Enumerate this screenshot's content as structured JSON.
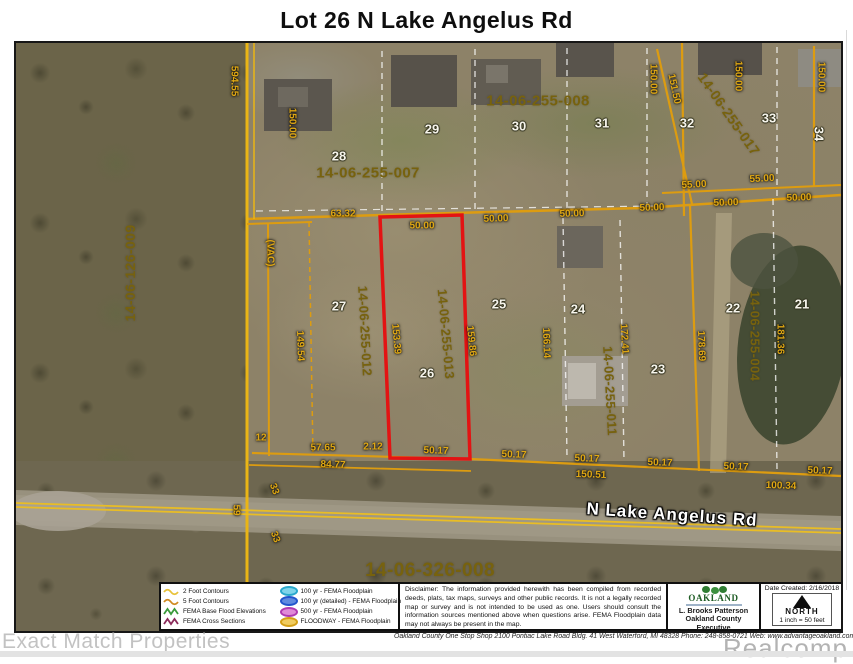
{
  "title": "Lot 26 N Lake Angelus Rd",
  "map": {
    "road_name": "N Lake Angelus Rd",
    "subject_lot": "26",
    "subject_parcel_id": "14-06-255-013",
    "labels": [
      {
        "t": "594.55",
        "x": 218,
        "y": 38,
        "r": 90,
        "k": "dim"
      },
      {
        "t": "150.00",
        "x": 276,
        "y": 80,
        "r": 90,
        "k": "dim"
      },
      {
        "t": "63.32",
        "x": 327,
        "y": 171,
        "r": 0,
        "k": "dim"
      },
      {
        "t": "50.00",
        "x": 406,
        "y": 183,
        "r": 0,
        "k": "dim"
      },
      {
        "t": "50.00",
        "x": 480,
        "y": 176,
        "r": -2,
        "k": "dim"
      },
      {
        "t": "50.00",
        "x": 556,
        "y": 171,
        "r": -2,
        "k": "dim"
      },
      {
        "t": "50.00",
        "x": 636,
        "y": 165,
        "r": -2,
        "k": "dim"
      },
      {
        "t": "50.00",
        "x": 710,
        "y": 160,
        "r": -2,
        "k": "dim"
      },
      {
        "t": "50.00",
        "x": 783,
        "y": 155,
        "r": -2,
        "k": "dim"
      },
      {
        "t": "55.00",
        "x": 678,
        "y": 142,
        "r": -3,
        "k": "dim"
      },
      {
        "t": "55.00",
        "x": 746,
        "y": 136,
        "r": -3,
        "k": "dim"
      },
      {
        "t": "150.00",
        "x": 637,
        "y": 36,
        "r": 90,
        "k": "dim"
      },
      {
        "t": "151.50",
        "x": 658,
        "y": 46,
        "r": 78,
        "k": "dim"
      },
      {
        "t": "150.00",
        "x": 722,
        "y": 33,
        "r": 90,
        "k": "dim"
      },
      {
        "t": "150.00",
        "x": 805,
        "y": 34,
        "r": 90,
        "k": "dim"
      },
      {
        "t": "(VAC)",
        "x": 254,
        "y": 210,
        "r": 90,
        "k": "dim"
      },
      {
        "t": "149.54",
        "x": 284,
        "y": 303,
        "r": 88,
        "k": "dim"
      },
      {
        "t": "153.39",
        "x": 380,
        "y": 296,
        "r": 85,
        "k": "dim"
      },
      {
        "t": "159.86",
        "x": 455,
        "y": 298,
        "r": 84,
        "k": "dim"
      },
      {
        "t": "166.14",
        "x": 530,
        "y": 300,
        "r": 88,
        "k": "dim"
      },
      {
        "t": "172.41",
        "x": 608,
        "y": 296,
        "r": 86,
        "k": "dim"
      },
      {
        "t": "178.69",
        "x": 685,
        "y": 303,
        "r": 88,
        "k": "dim"
      },
      {
        "t": "181.36",
        "x": 764,
        "y": 296,
        "r": 90,
        "k": "dim"
      },
      {
        "t": "12",
        "x": 245,
        "y": 395,
        "r": 0,
        "k": "dim"
      },
      {
        "t": "57.65",
        "x": 307,
        "y": 405,
        "r": 0,
        "k": "dim"
      },
      {
        "t": "2.12",
        "x": 357,
        "y": 404,
        "r": 0,
        "k": "dim"
      },
      {
        "t": "50.17",
        "x": 420,
        "y": 408,
        "r": 2,
        "k": "dim"
      },
      {
        "t": "50.17",
        "x": 498,
        "y": 412,
        "r": 2,
        "k": "dim"
      },
      {
        "t": "84.77",
        "x": 317,
        "y": 422,
        "r": 2,
        "k": "dim"
      },
      {
        "t": "50.17",
        "x": 571,
        "y": 416,
        "r": 2,
        "k": "dim"
      },
      {
        "t": "50.17",
        "x": 644,
        "y": 420,
        "r": 2,
        "k": "dim"
      },
      {
        "t": "50.17",
        "x": 720,
        "y": 424,
        "r": 2,
        "k": "dim"
      },
      {
        "t": "50.17",
        "x": 804,
        "y": 428,
        "r": 2,
        "k": "dim"
      },
      {
        "t": "150.51",
        "x": 575,
        "y": 432,
        "r": 2,
        "k": "dim"
      },
      {
        "t": "100.34",
        "x": 765,
        "y": 443,
        "r": 2,
        "k": "dim"
      },
      {
        "t": "33",
        "x": 258,
        "y": 446,
        "r": 70,
        "k": "dim"
      },
      {
        "t": "33",
        "x": 259,
        "y": 494,
        "r": 70,
        "k": "dim"
      },
      {
        "t": "59",
        "x": 220,
        "y": 467,
        "r": 90,
        "k": "dim"
      },
      {
        "t": "14-06-126-009",
        "x": 114,
        "y": 230,
        "r": -90,
        "k": "pid",
        "s": 14
      },
      {
        "t": "14-06-255-007",
        "x": 352,
        "y": 130,
        "r": 0,
        "k": "pid",
        "s": 15
      },
      {
        "t": "14-06-255-008",
        "x": 522,
        "y": 58,
        "r": 0,
        "k": "pid",
        "s": 15
      },
      {
        "t": "14-06-255-017",
        "x": 713,
        "y": 71,
        "r": 55,
        "k": "pid",
        "s": 14
      },
      {
        "t": "14-06-255-012",
        "x": 349,
        "y": 288,
        "r": 87,
        "k": "pid",
        "s": 13
      },
      {
        "t": "14-06-255-013",
        "x": 430,
        "y": 291,
        "r": 85,
        "k": "pid",
        "s": 13
      },
      {
        "t": "14-06-255-011",
        "x": 594,
        "y": 348,
        "r": 87,
        "k": "pid",
        "s": 13
      },
      {
        "t": "14-06-255-004",
        "x": 739,
        "y": 293,
        "r": 90,
        "k": "pid",
        "s": 13
      },
      {
        "t": "14-06-326-008",
        "x": 414,
        "y": 528,
        "r": 0,
        "k": "pid",
        "s": 19
      },
      {
        "t": "28",
        "x": 323,
        "y": 113,
        "r": 0,
        "k": "lot"
      },
      {
        "t": "29",
        "x": 416,
        "y": 86,
        "r": 0,
        "k": "lot"
      },
      {
        "t": "30",
        "x": 503,
        "y": 83,
        "r": 0,
        "k": "lot"
      },
      {
        "t": "31",
        "x": 586,
        "y": 80,
        "r": 0,
        "k": "lot"
      },
      {
        "t": "32",
        "x": 671,
        "y": 80,
        "r": 0,
        "k": "lot"
      },
      {
        "t": "33",
        "x": 753,
        "y": 75,
        "r": 0,
        "k": "lot"
      },
      {
        "t": "34",
        "x": 803,
        "y": 91,
        "r": 90,
        "k": "lot"
      },
      {
        "t": "27",
        "x": 323,
        "y": 263,
        "r": 0,
        "k": "lot"
      },
      {
        "t": "26",
        "x": 411,
        "y": 330,
        "r": 0,
        "k": "lot"
      },
      {
        "t": "25",
        "x": 483,
        "y": 261,
        "r": 0,
        "k": "lot"
      },
      {
        "t": "24",
        "x": 562,
        "y": 266,
        "r": 0,
        "k": "lot"
      },
      {
        "t": "23",
        "x": 642,
        "y": 326,
        "r": 0,
        "k": "lot"
      },
      {
        "t": "22",
        "x": 717,
        "y": 265,
        "r": 0,
        "k": "lot"
      },
      {
        "t": "21",
        "x": 786,
        "y": 261,
        "r": 0,
        "k": "lot"
      },
      {
        "t": "N Lake Angelus Rd",
        "x": 656,
        "y": 472,
        "r": 4,
        "k": "road"
      }
    ],
    "lines": [
      {
        "d": "M231,176 L400,171 L627,165 L825,152",
        "c": "orange",
        "w": 2.5
      },
      {
        "d": "M646,150 L825,142",
        "c": "orange",
        "w": 2
      },
      {
        "d": "M231,0 L231,540",
        "c": "yellow",
        "w": 3,
        "name": "west-boundary-line"
      },
      {
        "d": "M238,0 L238,176",
        "c": "yellow",
        "w": 1.5
      },
      {
        "d": "M252,181 L253,413",
        "c": "orange",
        "w": 2
      },
      {
        "d": "M231,181 L296,179",
        "c": "orange",
        "w": 2
      },
      {
        "d": "M293,179 L297,412",
        "c": "orange",
        "w": 1.5,
        "dash": "5,4"
      },
      {
        "d": "M666,0 L668,173",
        "c": "orange",
        "w": 2.2
      },
      {
        "d": "M641,6 L676,161",
        "c": "orange",
        "w": 2.2
      },
      {
        "d": "M798,3 L798,143",
        "c": "orange",
        "w": 2.2
      },
      {
        "d": "M366,8 L366,170",
        "c": "whiteDash",
        "w": 1.4,
        "dash": "6,5"
      },
      {
        "d": "M459,6 L459,168",
        "c": "whiteDash",
        "w": 1.4,
        "dash": "6,5"
      },
      {
        "d": "M551,5 L551,166",
        "c": "whiteDash",
        "w": 1.4,
        "dash": "6,5"
      },
      {
        "d": "M631,5 L631,163",
        "c": "whiteDash",
        "w": 1.4,
        "dash": "6,5"
      },
      {
        "d": "M761,4 L761,153",
        "c": "whiteDash",
        "w": 1.4,
        "dash": "6,5"
      },
      {
        "d": "M240,168 L640,163",
        "c": "whiteDash",
        "w": 1.2,
        "dash": "7,6"
      },
      {
        "d": "M547,175 L551,414",
        "c": "whiteDash",
        "w": 1.4,
        "dash": "6,5"
      },
      {
        "d": "M604,177 L608,418",
        "c": "whiteDash",
        "w": 1.4,
        "dash": "6,5"
      },
      {
        "d": "M757,156 L761,426",
        "c": "whiteDash",
        "w": 1.4,
        "dash": "6,5"
      },
      {
        "d": "M674,163 L683,428",
        "c": "orange",
        "w": 2.2
      },
      {
        "d": "M236,410 L454,416 L825,433",
        "c": "orange",
        "w": 2.2
      },
      {
        "d": "M233,422 L455,428",
        "c": "orange",
        "w": 1.8
      },
      {
        "d": "M0,460 L825,486",
        "c": "roadline",
        "w": 1.8
      },
      {
        "d": "M0,464 L825,490",
        "c": "roadline",
        "w": 1.8
      },
      {
        "d": "M364,174 L446,172 L454,416 L374,415 Z",
        "c": "red",
        "w": 3.5,
        "name": "subject-lot-outline"
      }
    ]
  },
  "legend": {
    "left": [
      {
        "label": "2 Foot Contours",
        "symbol": "wave",
        "color": "#e8c23a"
      },
      {
        "label": "5 Foot Contours",
        "symbol": "wave",
        "color": "#d08a20"
      },
      {
        "label": "FEMA Base Flood Elevations",
        "symbol": "zigzag",
        "color": "#3a9a3a"
      },
      {
        "label": "FEMA Cross Sections",
        "symbol": "zigzag",
        "color": "#8b2a5a"
      }
    ],
    "right": [
      {
        "label": "100 yr - FEMA Floodplain",
        "symbol": "oval",
        "stroke": "#29a8cc",
        "fill": "#7fd4ea"
      },
      {
        "label": "100 yr (detailed) - FEMA Floodplain",
        "symbol": "oval",
        "stroke": "#2255cc",
        "fill": "#5f8ae0"
      },
      {
        "label": "500 yr - FEMA Floodplain",
        "symbol": "oval",
        "stroke": "#b03ab0",
        "fill": "#e08ad8"
      },
      {
        "label": "FLOODWAY - FEMA Floodplain",
        "symbol": "oval",
        "stroke": "#d4a017",
        "fill": "#f0cc60"
      }
    ],
    "disclaimer": "Disclaimer:  The information provided herewith has been compiled from recorded deeds, plats, tax maps, surveys and other public records.  It is not a legally recorded map or survey and is not intended to be used as one.  Users should consult the information sources mentioned above when questions arise. FEMA Floodplain data may not always be present in the map.",
    "executive": {
      "org": "OAKLAND",
      "name": "L. Brooks Patterson",
      "title": "Oakland County Executive"
    },
    "date_created": "Date Created: 2/16/2018",
    "north": "NORTH",
    "scale": "1 inch = 50 feet"
  },
  "footer": {
    "watermark_left": "Exact Match Properties",
    "address": "Oakland County One Stop Shop   2100 Pontiac Lake Road  Bldg. 41 West   Waterford, MI 48328   Phone: 248-858-0721   Web: www.advantageoakland.com",
    "watermark_right": "Realcomp"
  },
  "colors": {
    "orange": "#dd9c10",
    "yellow": "#eab515",
    "whiteDash": "rgba(255,255,255,0.75)",
    "red": "#e31313",
    "roadline": "#e9bd25",
    "dim_text": "#dfa713",
    "parcel_id_text": "#77620e",
    "lot_text": "#f7f5ec",
    "road_text": "#ffffff"
  }
}
